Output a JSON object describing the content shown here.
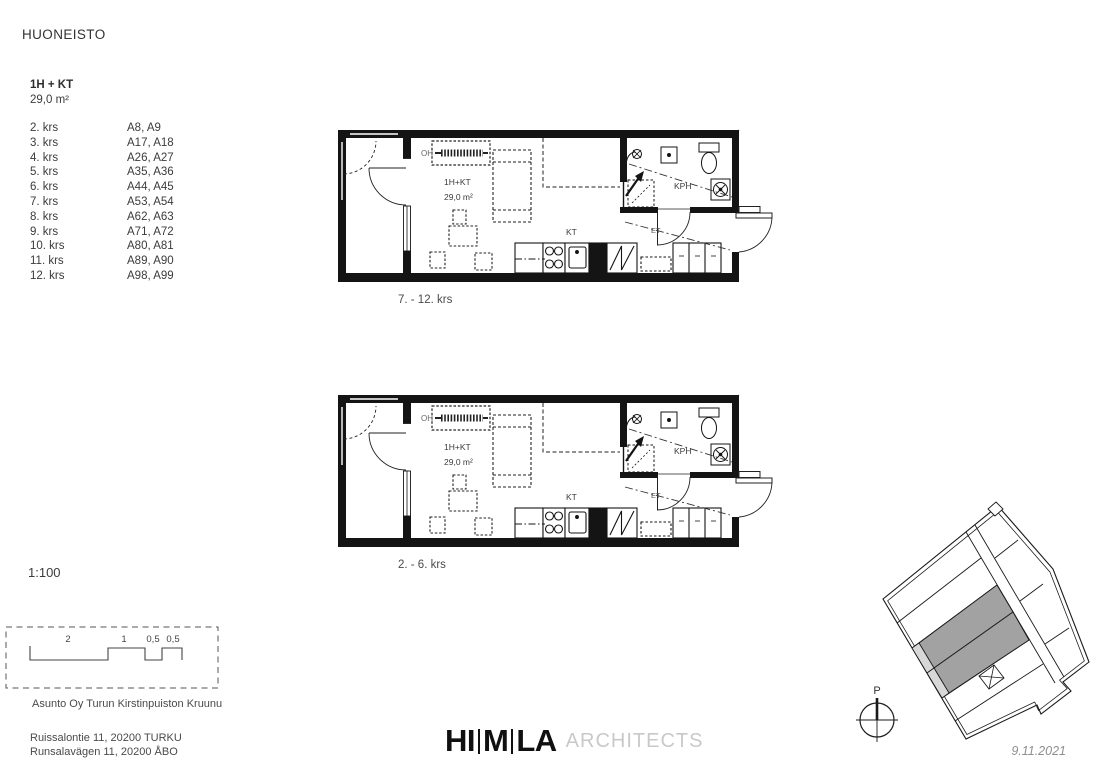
{
  "page": {
    "title": "HUONEISTO"
  },
  "apartment": {
    "type": "1H + KT",
    "area": "29,0 m²"
  },
  "floors": [
    {
      "floor": "2. krs",
      "apartments": "A8, A9"
    },
    {
      "floor": "3. krs",
      "apartments": "A17, A18"
    },
    {
      "floor": "4. krs",
      "apartments": "A26, A27"
    },
    {
      "floor": "5. krs",
      "apartments": "A35, A36"
    },
    {
      "floor": "6. krs",
      "apartments": "A44, A45"
    },
    {
      "floor": "7. krs",
      "apartments": "A53, A54"
    },
    {
      "floor": "8. krs",
      "apartments": "A62, A63"
    },
    {
      "floor": "9. krs",
      "apartments": "A71, A72"
    },
    {
      "floor": "10. krs",
      "apartments": "A80, A81"
    },
    {
      "floor": "11. krs",
      "apartments": "A89, A90"
    },
    {
      "floor": "12. krs",
      "apartments": "A98, A99"
    }
  ],
  "plans": [
    {
      "caption": "7. - 12. krs",
      "labels": {
        "type": "1H+KT",
        "area": "29,0 m²",
        "kitchen": "KT",
        "bathroom": "KPH",
        "entry": "ET",
        "living": "OH"
      }
    },
    {
      "caption": "2. - 6. krs",
      "labels": {
        "type": "1H+KT",
        "area": "29,0 m²",
        "kitchen": "KT",
        "bathroom": "KPH",
        "entry": "ET",
        "living": "OH"
      }
    }
  ],
  "scale": {
    "ratio": "1:100",
    "bar_labels": [
      "2",
      "1",
      "0,5",
      "0,5"
    ]
  },
  "project": {
    "name": "Asunto Oy Turun Kirstinpuiston Kruunu",
    "address_fi": "Ruissalontie 11, 20200 TURKU",
    "address_sv": "Runsalavägen 11, 20200 ÅBO"
  },
  "logo": {
    "part1": "HI",
    "part2": "M",
    "part3": "LA",
    "suffix": "ARCHITECTS"
  },
  "site_plan": {
    "north_label": "P",
    "date": "9.11.2021"
  },
  "colors": {
    "wall": "#141414",
    "highlight_dark": "#a2a2a2",
    "highlight_light": "#d8d8d8",
    "text": "#3b3b3b",
    "muted": "#8f8f8f"
  }
}
